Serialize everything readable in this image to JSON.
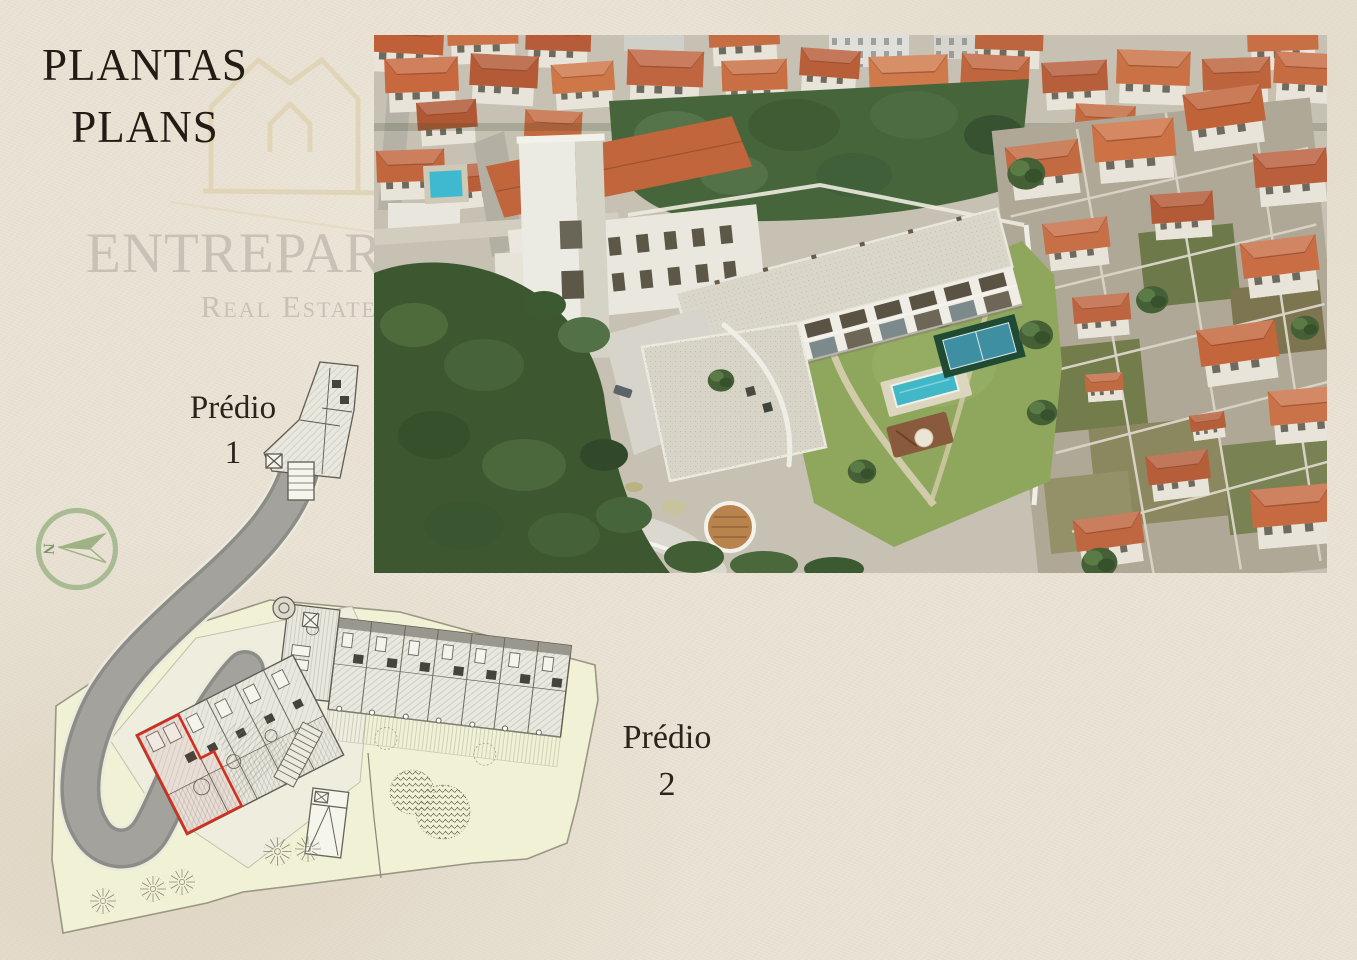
{
  "slide": {
    "title": {
      "line1": "PLANTAS",
      "line2": "PLANS"
    },
    "watermark": {
      "brand": "ENTREPAREDES",
      "tagline": "Real Estate"
    },
    "logo": {
      "icon": "house-outline-logo",
      "color": "#e0d4b4"
    },
    "compass": {
      "icon": "compass-north-arrow",
      "north_label": "N",
      "color": "#a4b88f"
    },
    "labels": {
      "building1_line1": "Prédio",
      "building1_line2": "1",
      "building2_line1": "Prédio",
      "building2_line2": "2"
    },
    "site_plan": {
      "highlight_color": "#d22f21",
      "site_fill": "#f0f1d5",
      "road_color": "#9c9c9c"
    },
    "colors": {
      "background": "#e9e2d4",
      "title_text": "#221c15",
      "watermark_text": "#c9c1b6",
      "roof_terracotta": "#c8683e",
      "pool_water": "#41b7c8",
      "lawn_green": "#8fa75c"
    }
  }
}
